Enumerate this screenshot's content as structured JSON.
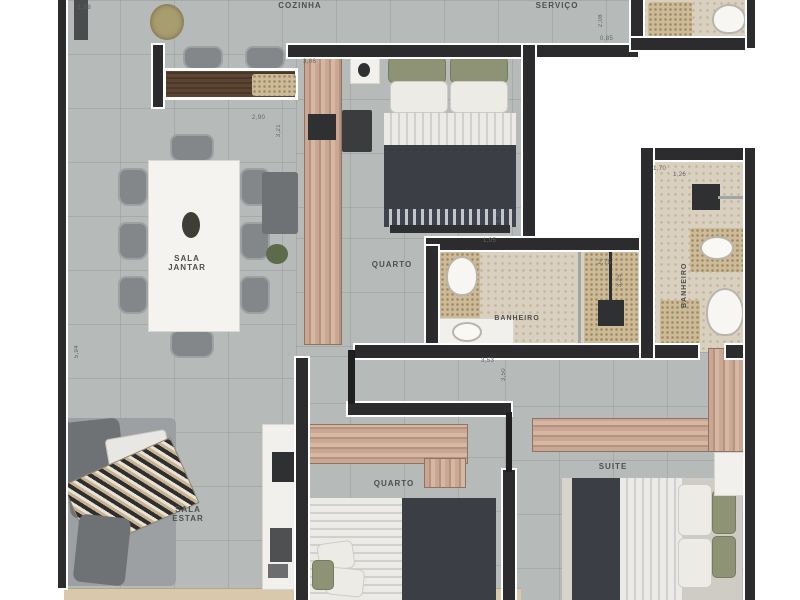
{
  "plan_type": "apartment-floor-plan",
  "labels": {
    "cozinha": "COZINHA",
    "servico": "SERVIÇO",
    "sala_jantar_line1": "SALA",
    "sala_jantar_line2": "JANTAR",
    "quarto_top": "QUARTO",
    "banheiro_mid": "BANHEIRO",
    "banheiro_right": "BANHEIRO",
    "sala_estar_line1": "SALA",
    "sala_estar_line2": "ESTAR",
    "quarto_bottom": "QUARTO",
    "suite": "SUITE"
  },
  "dimensions": [
    {
      "text": "1,08"
    },
    {
      "text": "3,06"
    },
    {
      "text": "2,90"
    },
    {
      "text": "3,21"
    },
    {
      "text": "2,08"
    },
    {
      "text": "0,85"
    },
    {
      "text": "1,70"
    },
    {
      "text": "1,26"
    },
    {
      "text": "3,30"
    },
    {
      "text": "1,05"
    },
    {
      "text": "2,75"
    },
    {
      "text": "3,25"
    },
    {
      "text": "3,53"
    },
    {
      "text": "3,50"
    },
    {
      "text": "5,94"
    }
  ],
  "colors": {
    "floor_tile": "#b6bab9",
    "bath_floor": "#dad0c0",
    "wall": "#2c2c2e",
    "wood_closet": "#c9a794",
    "dark_bedding": "#3b3e45",
    "green_cushion": "#8f9376",
    "counter_wood": "#5c4532",
    "balcony": "#d8c8ac"
  }
}
